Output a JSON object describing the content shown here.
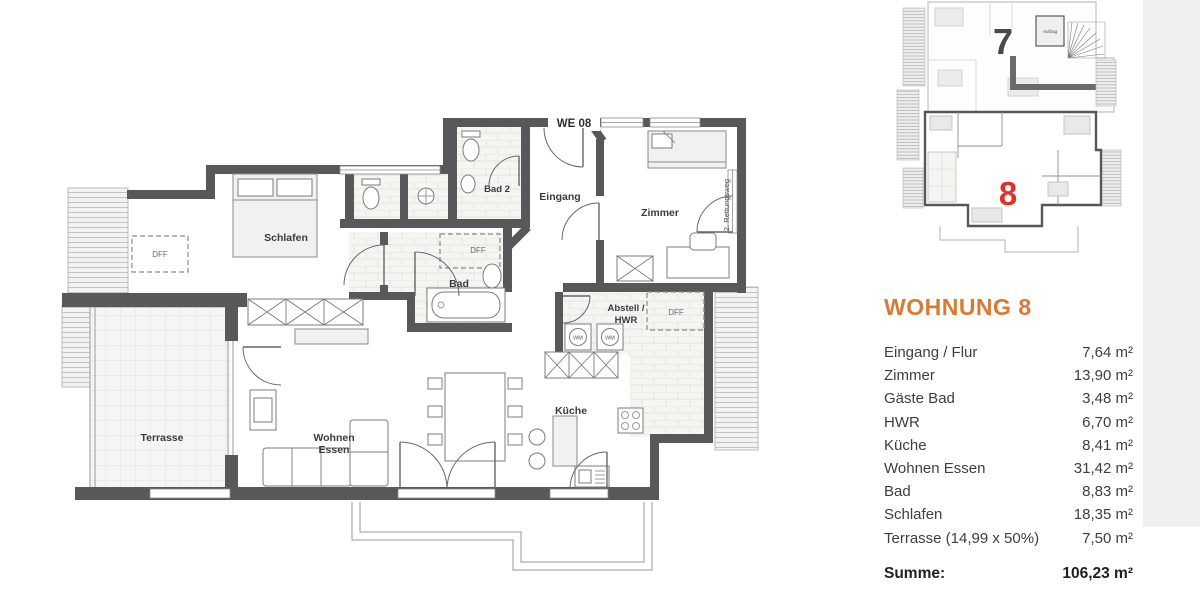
{
  "colors": {
    "accent": "#D97A33",
    "wall": "#58585A",
    "unit8_red": "#E0312A",
    "unit7_gray": "#4A4A4A"
  },
  "overview": {
    "unit7": "7",
    "unit8": "8",
    "aufzug": "Aufzug"
  },
  "plan": {
    "labels": {
      "we08": "WE 08",
      "bad2": "Bad 2",
      "eingang": "Eingang",
      "zimmer": "Zimmer",
      "rettungsweg": "2. Rettungsweg",
      "schlafen": "Schlafen",
      "bad": "Bad",
      "abstell1": "Abstell /",
      "abstell2": "HWR",
      "kueche": "Küche",
      "wohnen": "Wohnen",
      "essen": "Essen",
      "terrasse": "Terrasse",
      "dff": "DFF",
      "wm": "WM"
    }
  },
  "panel": {
    "title": "WOHNUNG 8",
    "rows": [
      {
        "label": "Eingang / Flur",
        "value": "7,64 m²"
      },
      {
        "label": "Zimmer",
        "value": "13,90 m²"
      },
      {
        "label": "Gäste Bad",
        "value": "3,48 m²"
      },
      {
        "label": "HWR",
        "value": "6,70 m²"
      },
      {
        "label": "Küche",
        "value": "8,41 m²"
      },
      {
        "label": "Wohnen Essen",
        "value": "31,42 m²"
      },
      {
        "label": "Bad",
        "value": "8,83 m²"
      },
      {
        "label": "Schlafen",
        "value": "18,35 m²"
      },
      {
        "label": "Terrasse (14,99 x 50%)",
        "value": "7,50 m²"
      }
    ],
    "sum_label": "Summe:",
    "sum_value": "106,23 m²"
  }
}
